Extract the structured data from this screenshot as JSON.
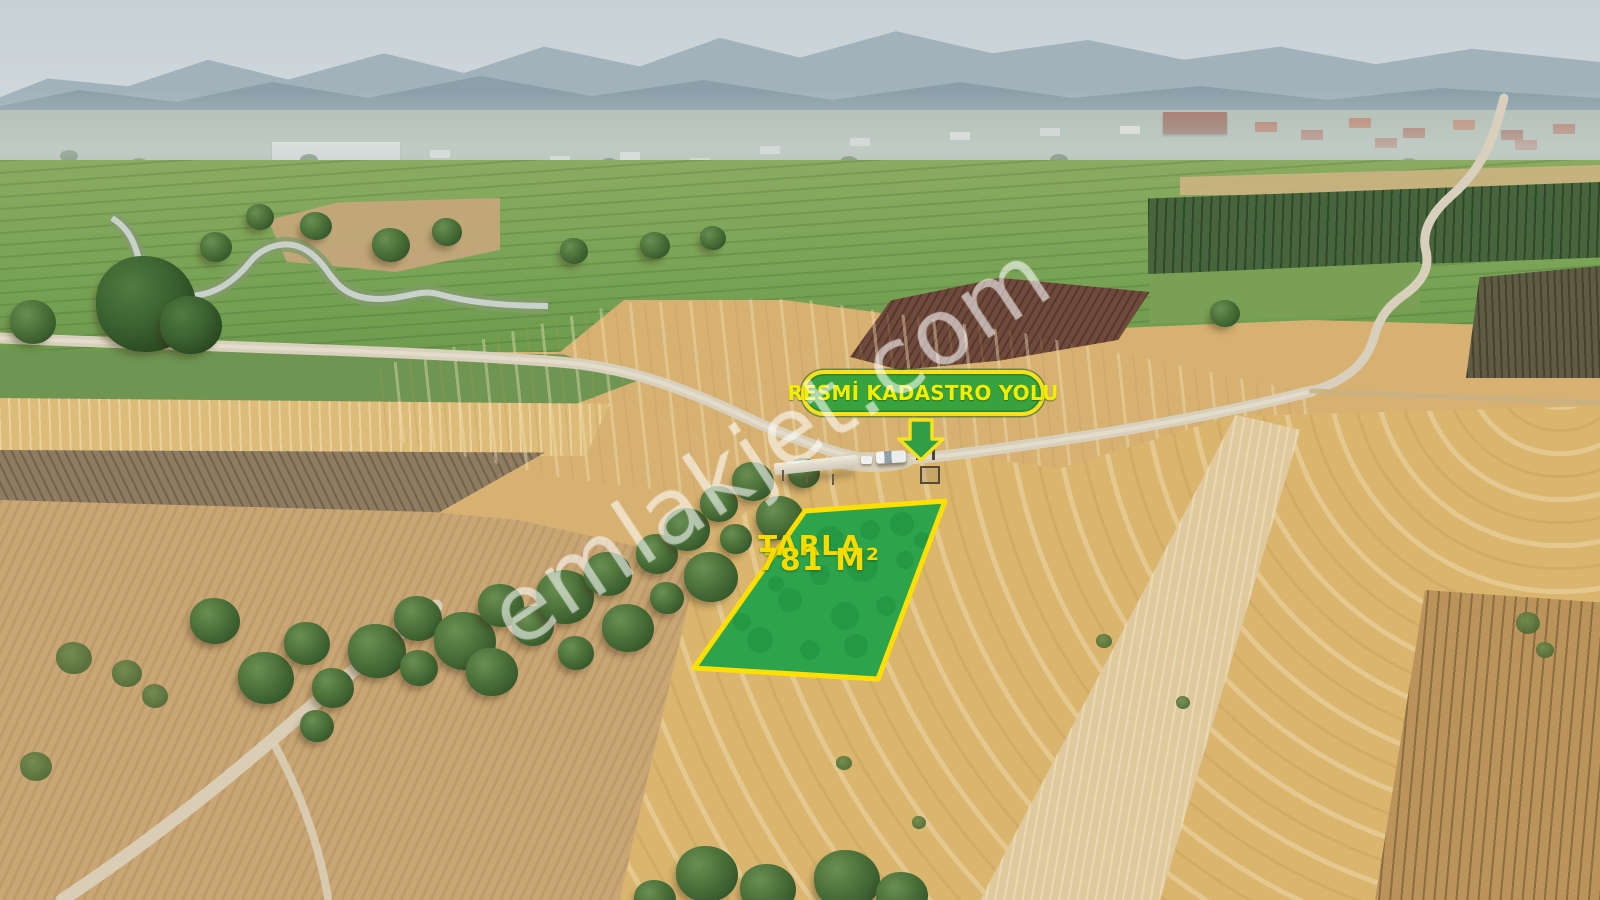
{
  "annotations": {
    "road_label": "RESMİ KADASTRO YOLU",
    "parcel_name": "TARLA",
    "parcel_area": "781 M²"
  },
  "watermark": {
    "text": "emlakjet.com"
  },
  "icons": {
    "arrow": "down-arrow-icon"
  },
  "colors": {
    "highlight_yellow": "#f6e11c",
    "highlight_green": "#38a23e",
    "parcel_fill": "#2da44c",
    "annotation_text_yellow": "#f2ee00"
  }
}
